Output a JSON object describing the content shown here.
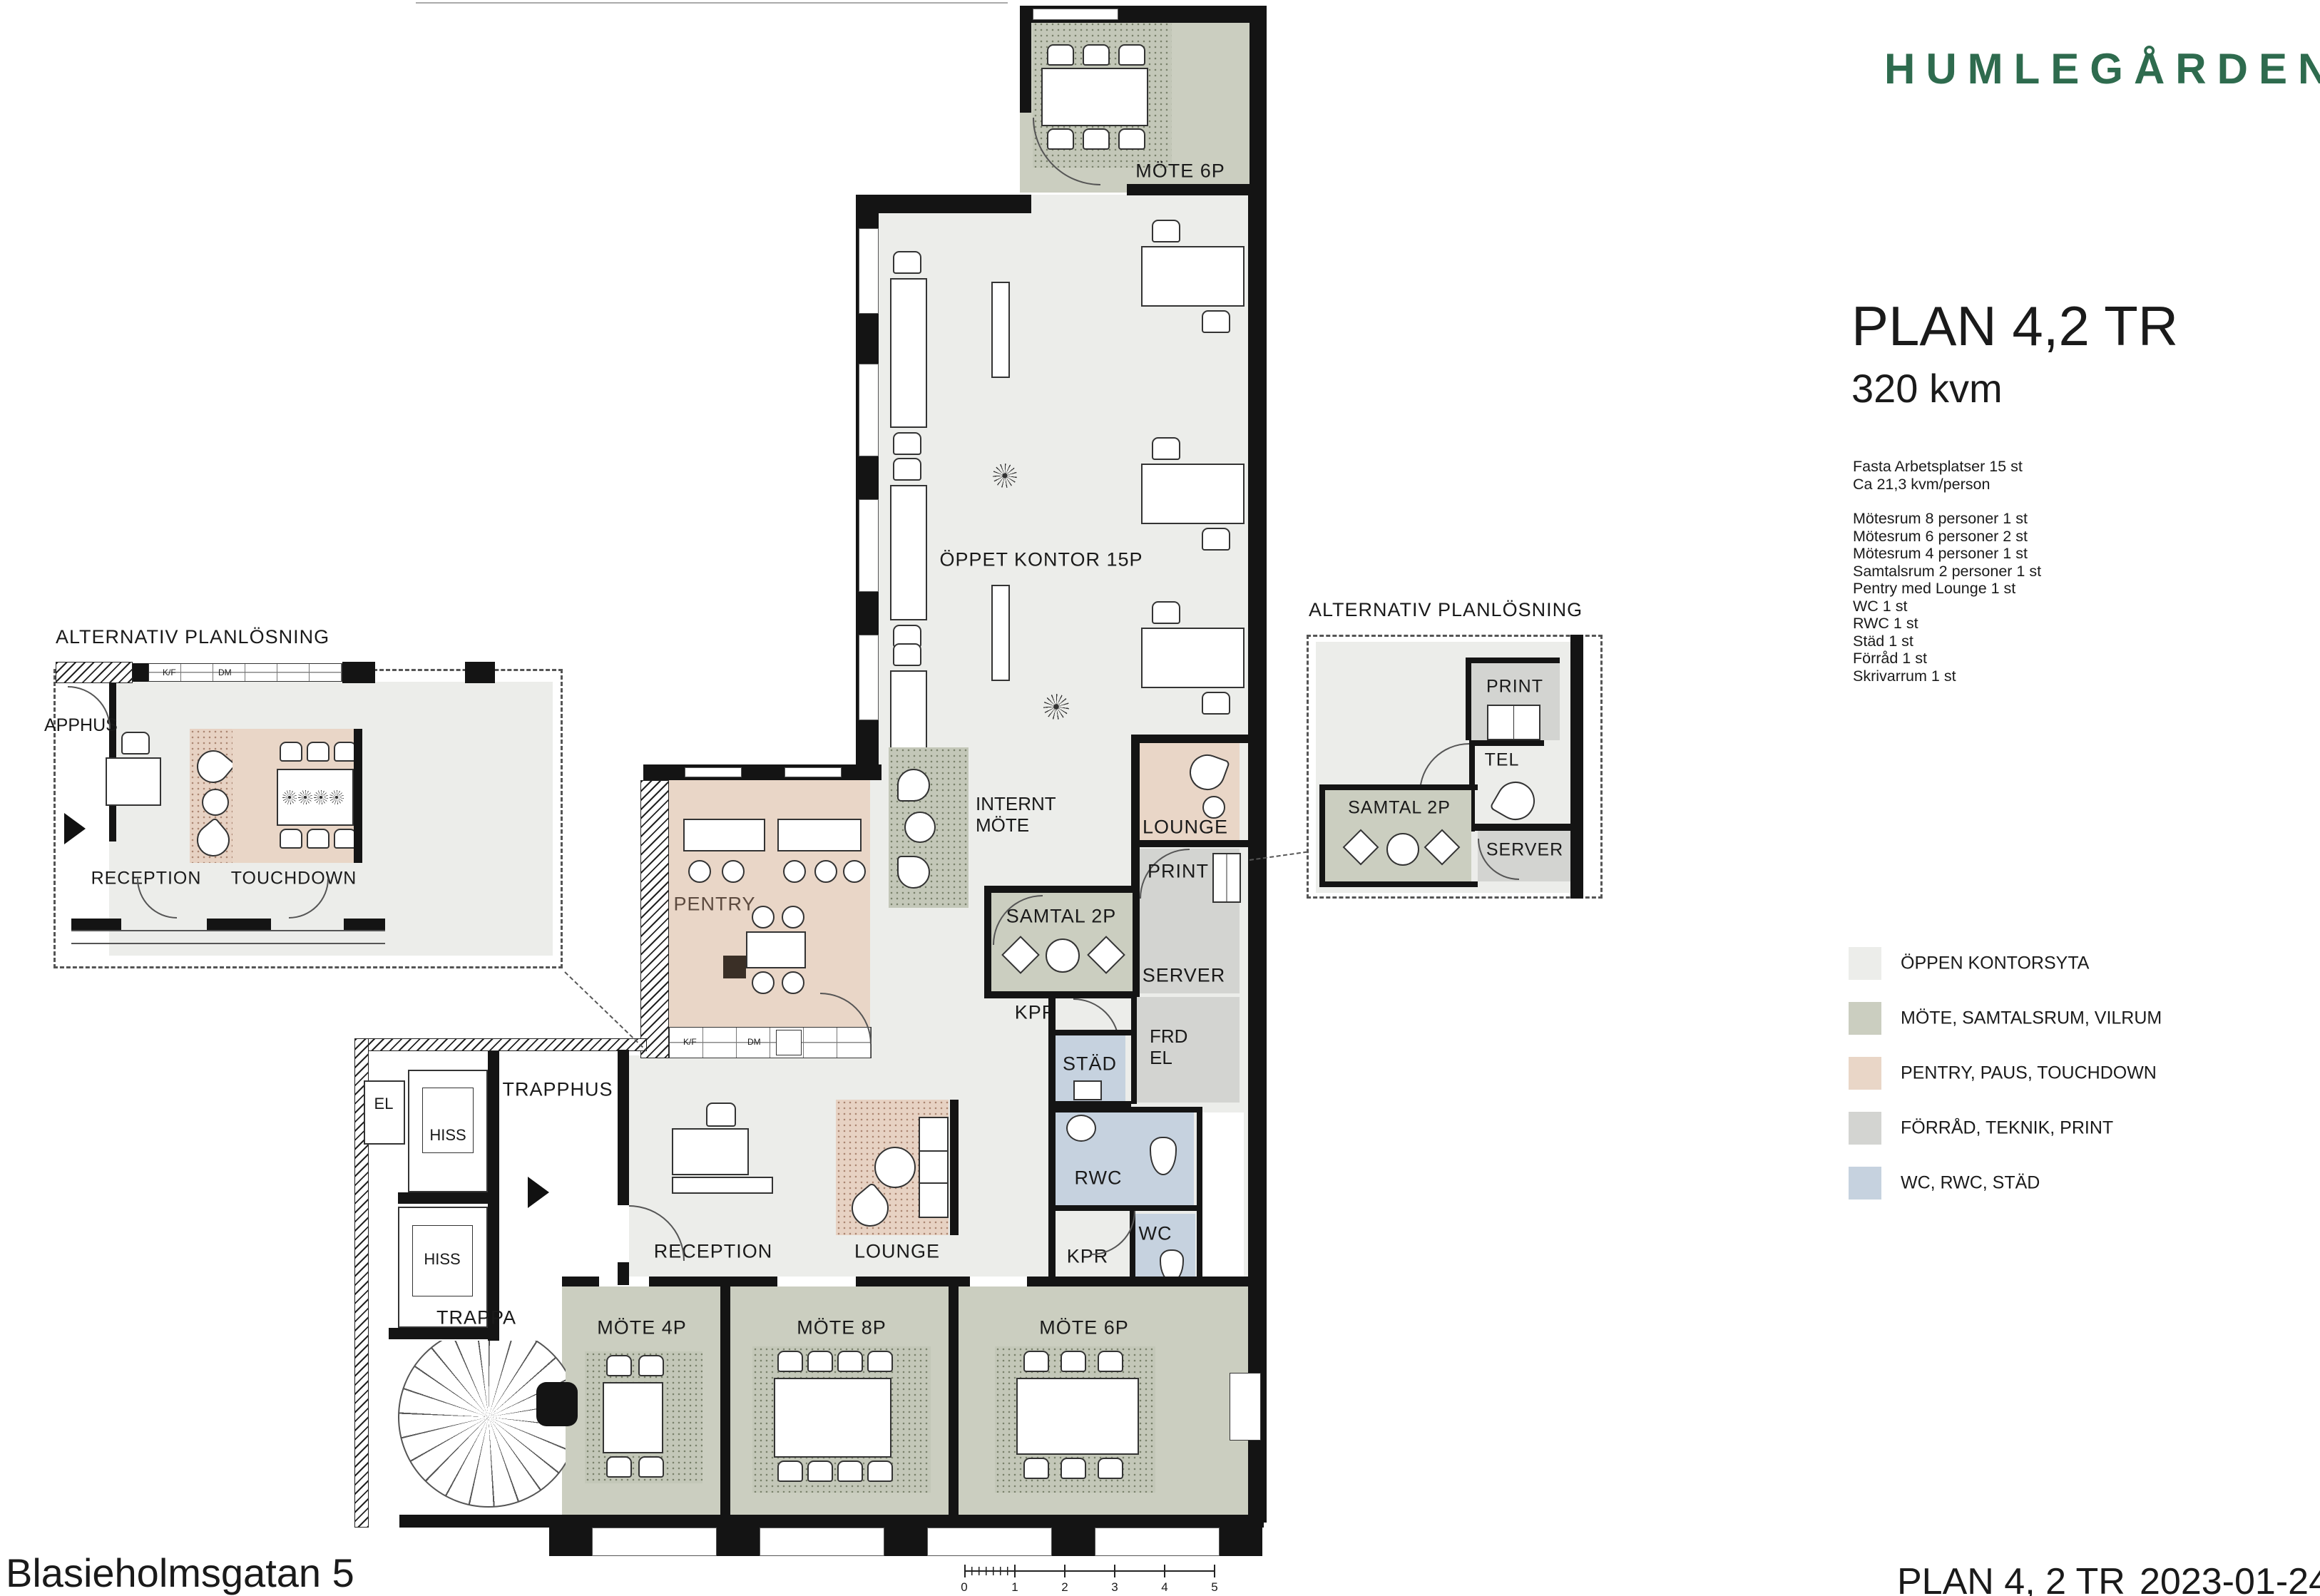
{
  "brand": {
    "logo": "HUMLEGÅRDEN",
    "logo_color": "#2E6B4E"
  },
  "title": {
    "heading": "PLAN 4,2 TR",
    "subheading": "320 kvm"
  },
  "facts": {
    "intro": [
      "Fasta Arbetsplatser 15 st",
      "Ca 21,3 kvm/person"
    ],
    "rooms": [
      "Mötesrum 8 personer 1 st",
      "Mötesrum 6 personer 2 st",
      "Mötesrum 4 personer 1 st",
      "Samtalsrum 2 personer 1 st",
      "Pentry med Lounge 1 st",
      "WC 1 st",
      "RWC 1 st",
      "Städ 1 st",
      "Förråd 1 st",
      "Skrivarrum 1 st"
    ]
  },
  "legend": {
    "items": [
      {
        "label": "ÖPPEN KONTORSYTA",
        "color": "#ECEDEA"
      },
      {
        "label": "MÖTE, SAMTALSRUM, VILRUM",
        "color": "#CBCEC0"
      },
      {
        "label": "PENTRY, PAUS, TOUCHDOWN",
        "color": "#E9D6C7"
      },
      {
        "label": "FÖRRÅD, TEKNIK, PRINT",
        "color": "#D3D4D1"
      },
      {
        "label": "WC, RWC, STÄD",
        "color": "#C6D2DF"
      }
    ]
  },
  "plan": {
    "mote6p_top": "MÖTE 6P",
    "oppet_kontor": "ÖPPET KONTOR 15P",
    "internt_mote": "INTERNT MÖTE",
    "lounge_upper": "LOUNGE",
    "print": "PRINT",
    "samtal2p": "SAMTAL 2P",
    "server": "SERVER",
    "kpr_upper": "KPR",
    "stad": "STÄD",
    "frd_el": "FRD EL",
    "rwc": "RWC",
    "wc": "WC",
    "kpr_lower": "KPR",
    "pentry": "PENTRY",
    "reception": "RECEPTION",
    "lounge_lower": "LOUNGE",
    "trapphus": "TRAPPHUS",
    "el": "EL",
    "hiss1": "HISS",
    "hiss2": "HISS",
    "trappa": "TRAPPA",
    "mote4p": "MÖTE 4P",
    "mote8p": "MÖTE 8P",
    "mote6p_bottom": "MÖTE 6P"
  },
  "appliances": {
    "kf": "K/F",
    "dm": "DM"
  },
  "insets": {
    "left": {
      "title": "ALTERNATIV PLANLÖSNING",
      "trapphus": "APPHUS",
      "reception": "RECEPTION",
      "touchdown": "TOUCHDOWN"
    },
    "right": {
      "title": "ALTERNATIV PLANLÖSNING",
      "print": "PRINT",
      "tel": "TEL",
      "samtal2p": "SAMTAL 2P",
      "server": "SERVER"
    }
  },
  "scale_bar": {
    "ticks": [
      "0",
      "1",
      "2",
      "3",
      "4",
      "5"
    ]
  },
  "footer": {
    "address": "Blasieholmsgatan 5",
    "plan": "PLAN 4, 2 TR",
    "date": "2023-01-24"
  }
}
